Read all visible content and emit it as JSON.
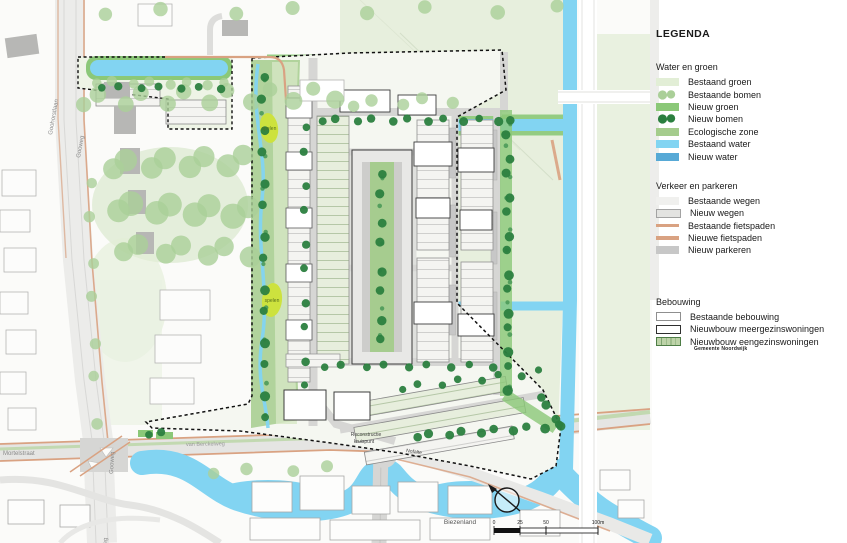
{
  "legend": {
    "title": "LEGENDA",
    "sections": [
      {
        "title": "Water en groen",
        "items": [
          {
            "label": "Bestaand groen"
          },
          {
            "label": "Bestaande bomen"
          },
          {
            "label": "Nieuw groen"
          },
          {
            "label": "Nieuw bomen"
          },
          {
            "label": "Ecologische zone"
          },
          {
            "label": "Bestaand water"
          },
          {
            "label": "Nieuw water"
          }
        ]
      },
      {
        "title": "Verkeer en parkeren",
        "items": [
          {
            "label": "Bestaande wegen"
          },
          {
            "label": "Nieuw wegen"
          },
          {
            "label": "Bestaande fietspaden"
          },
          {
            "label": "Nieuwe fietspaden"
          },
          {
            "label": "Nieuw parkeren"
          }
        ]
      },
      {
        "title": "Bebouwing",
        "items": [
          {
            "label": "Bestaande bebouwing"
          },
          {
            "label": "Nieuwbouw meergezinswoningen"
          },
          {
            "label": "Nieuwbouw eengezinswoningen"
          }
        ]
      }
    ]
  },
  "map": {
    "labels": {
      "goohorstlaan": "Goohorstlaan",
      "gooweg1": "Gooweg",
      "gooweg2": "Gooweg",
      "gooweg3": "Gooweg",
      "mortelstraat": "Mortelstraat",
      "van_berckelweg": "van Berckelweg",
      "reconstructie1": "Reconstructie",
      "reconstructie2": "kruispunt",
      "nofalte": "Nofalte",
      "spelen1": "spelen",
      "spelen2": "spelen",
      "biezenland": "Biezenland"
    },
    "scalebar": {
      "t0": "0",
      "t25": "25",
      "t50": "50",
      "t100": "100m"
    },
    "credit": "Gemeente Noordwijk"
  },
  "colors": {
    "bestaand-groen": "#e2eed6",
    "bestaande-bomen": "#aacf98",
    "nieuw-groen": "#8bc878",
    "nieuw-bomen": "#2b7f3f",
    "ecologische-zone": "#a5cc8d",
    "bestaand-water": "#82d4f2",
    "nieuw-water": "#57a9d6",
    "bestaande-wegen": "#f0f0ee",
    "nieuw-wegen": "#e3e3e1",
    "fietspad": "#d9a282",
    "nieuw-parkeren": "#c7c7c7",
    "eengezins-vlak": "#bdd3a8",
    "spelen": "#cde23e",
    "straat": "#d6d6d4",
    "veld": "#e7efdd"
  }
}
